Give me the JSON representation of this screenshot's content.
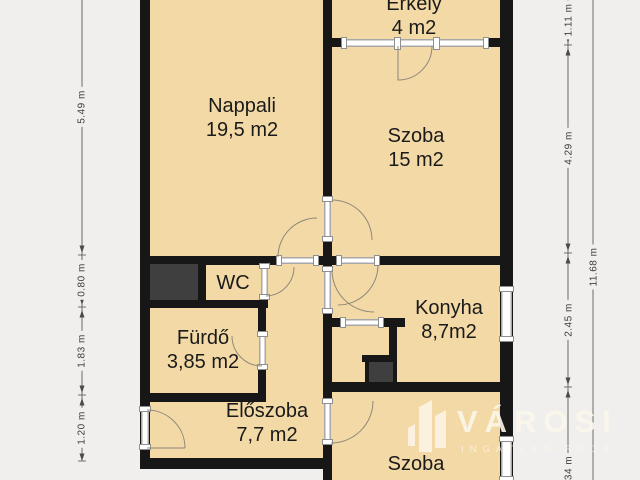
{
  "rooms": [
    {
      "id": "erkely",
      "name": "Erkély",
      "area": "4 m2"
    },
    {
      "id": "nappali",
      "name": "Nappali",
      "area": "19,5 m2"
    },
    {
      "id": "szoba1",
      "name": "Szoba",
      "area": "15 m2"
    },
    {
      "id": "wc",
      "name": "WC",
      "area": ""
    },
    {
      "id": "furdo",
      "name": "Fürdő",
      "area": "3,85 m2"
    },
    {
      "id": "konyha",
      "name": "Konyha",
      "area": "8,7m2"
    },
    {
      "id": "eloszoba",
      "name": "Előszoba",
      "area": "7,7 m2"
    },
    {
      "id": "szoba2",
      "name": "Szoba",
      "area": ""
    }
  ],
  "dimensions": {
    "left": [
      "5.49 m",
      "0.80 m",
      "1.83 m",
      "1.20 m"
    ],
    "right_inner": [
      "1.11 m",
      "4.29 m",
      "2.45 m",
      "34 m"
    ],
    "right_outer": "11.68 m"
  },
  "watermark": {
    "brand": "VÁROSI",
    "tagline": "INGATLANIRODA"
  },
  "colors": {
    "room_fill": "#f3d9a6",
    "wall": "#171717",
    "background": "#f0efed",
    "shaft_fill": "#3f3f3f",
    "watermark": "#f8f1e2"
  }
}
